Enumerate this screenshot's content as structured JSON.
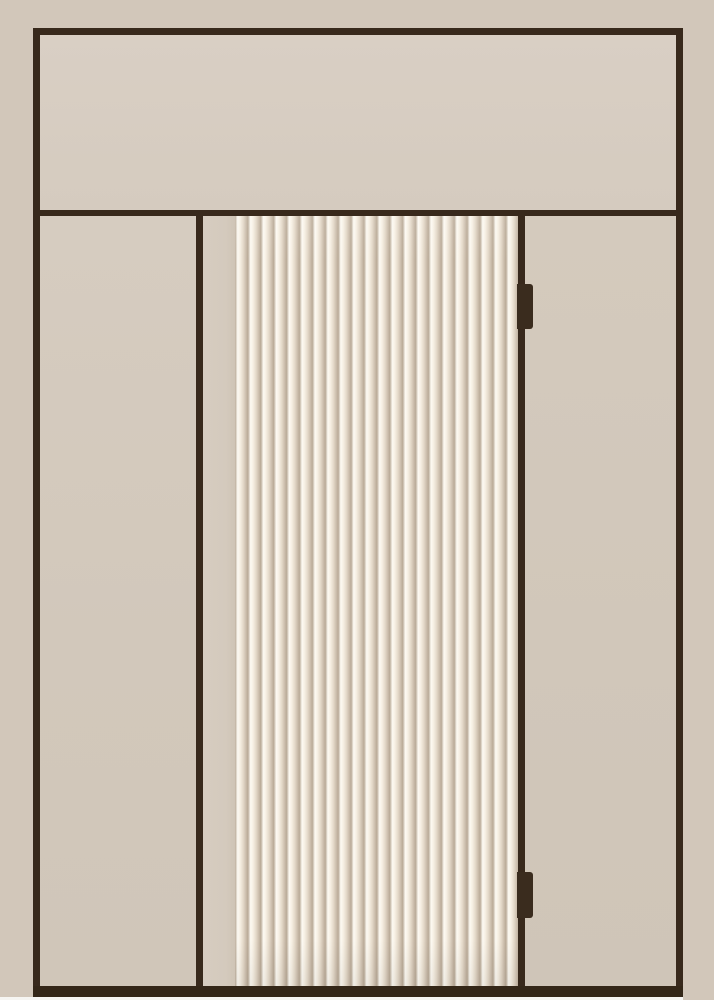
{
  "scene": {
    "description": "Flat elevation render of a beige door with transom panel, fluted center door leaf, side panels and two hinges",
    "colors": {
      "margin-color": "#d2c7ba",
      "frame-color": "#38291c",
      "threshold-color": "#342718",
      "transom-top": "#d9cfc4",
      "transom-bottom": "#d5cbbf",
      "flute-highlight": "#fdfaf3",
      "flute-dark": "#b9aa97",
      "hinge-color": "#3a2c1e",
      "strip-color": "#f6f5f2"
    },
    "door": {
      "hinge_count": 2,
      "flute_count": 22,
      "labels": {
        "transom": "transom-panel",
        "left_panel": "left-side-panel",
        "door_leaf": "fluted-door-leaf",
        "right_panel": "right-side-panel",
        "threshold": "threshold-bar"
      }
    }
  }
}
